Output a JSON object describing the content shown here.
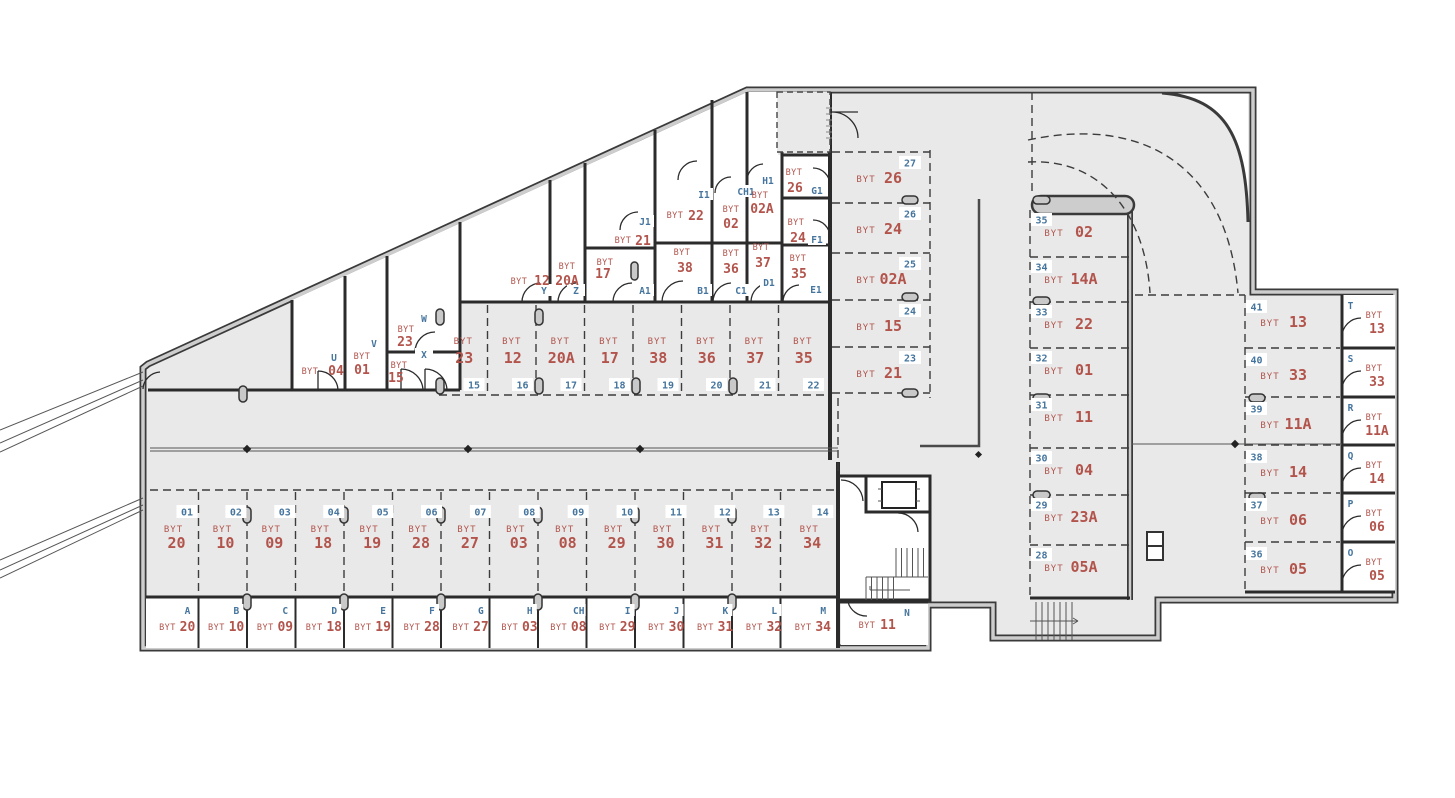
{
  "labels": {
    "unit_prefix": "BYT"
  },
  "colors": {
    "unit_red": "#b2544c",
    "code_blue": "#45759e",
    "floor_grey": "#e9e9e9",
    "wall_dark": "#3a3a3a"
  },
  "parking": {
    "bottom_row": [
      {
        "stall": "01",
        "unit": "20"
      },
      {
        "stall": "02",
        "unit": "10"
      },
      {
        "stall": "03",
        "unit": "09"
      },
      {
        "stall": "04",
        "unit": "18"
      },
      {
        "stall": "05",
        "unit": "19"
      },
      {
        "stall": "06",
        "unit": "28"
      },
      {
        "stall": "07",
        "unit": "27"
      },
      {
        "stall": "08",
        "unit": "03"
      },
      {
        "stall": "09",
        "unit": "08"
      },
      {
        "stall": "10",
        "unit": "29"
      },
      {
        "stall": "11",
        "unit": "30"
      },
      {
        "stall": "12",
        "unit": "31"
      },
      {
        "stall": "13",
        "unit": "32"
      },
      {
        "stall": "14",
        "unit": "34"
      }
    ],
    "middle_row": [
      {
        "stall": "15",
        "unit": "23"
      },
      {
        "stall": "16",
        "unit": "12"
      },
      {
        "stall": "17",
        "unit": "20A"
      },
      {
        "stall": "18",
        "unit": "17"
      },
      {
        "stall": "19",
        "unit": "38"
      },
      {
        "stall": "20",
        "unit": "36"
      },
      {
        "stall": "21",
        "unit": "37"
      },
      {
        "stall": "22",
        "unit": "35"
      }
    ],
    "upper_column": [
      {
        "stall": "27",
        "unit": "26"
      },
      {
        "stall": "26",
        "unit": "24"
      },
      {
        "stall": "25",
        "unit": "02A"
      },
      {
        "stall": "24",
        "unit": "15"
      },
      {
        "stall": "23",
        "unit": "21"
      }
    ],
    "right_column": [
      {
        "stall": "35",
        "unit": "02"
      },
      {
        "stall": "34",
        "unit": "14A"
      },
      {
        "stall": "33",
        "unit": "22"
      },
      {
        "stall": "32",
        "unit": "01"
      },
      {
        "stall": "31",
        "unit": "11"
      },
      {
        "stall": "30",
        "unit": "04"
      },
      {
        "stall": "29",
        "unit": "23A"
      },
      {
        "stall": "28",
        "unit": "05A"
      }
    ],
    "far_right_column": [
      {
        "stall": "41",
        "unit": "13"
      },
      {
        "stall": "40",
        "unit": "33"
      },
      {
        "stall": "39",
        "unit": "11A"
      },
      {
        "stall": "38",
        "unit": "14"
      },
      {
        "stall": "37",
        "unit": "06"
      },
      {
        "stall": "36",
        "unit": "05"
      }
    ]
  },
  "cellars": {
    "bottom_row": [
      {
        "code": "A",
        "unit": "20"
      },
      {
        "code": "B",
        "unit": "10"
      },
      {
        "code": "C",
        "unit": "09"
      },
      {
        "code": "D",
        "unit": "18"
      },
      {
        "code": "E",
        "unit": "19"
      },
      {
        "code": "F",
        "unit": "28"
      },
      {
        "code": "G",
        "unit": "27"
      },
      {
        "code": "H",
        "unit": "03"
      },
      {
        "code": "CH",
        "unit": "08"
      },
      {
        "code": "I",
        "unit": "29"
      },
      {
        "code": "J",
        "unit": "30"
      },
      {
        "code": "K",
        "unit": "31"
      },
      {
        "code": "L",
        "unit": "32"
      },
      {
        "code": "M",
        "unit": "34"
      },
      {
        "code": "N",
        "unit": "11"
      }
    ],
    "right_column": [
      {
        "code": "T",
        "unit": "13"
      },
      {
        "code": "S",
        "unit": "33"
      },
      {
        "code": "R",
        "unit": "11A"
      },
      {
        "code": "Q",
        "unit": "14"
      },
      {
        "code": "P",
        "unit": "06"
      },
      {
        "code": "O",
        "unit": "05"
      }
    ],
    "top_band": [
      {
        "code": "U",
        "unit": "04"
      },
      {
        "code": "V",
        "unit": "01"
      },
      {
        "code": "W",
        "unit": "23"
      },
      {
        "code": "X",
        "unit": "15"
      },
      {
        "code": "Y",
        "unit": "12"
      },
      {
        "code": "Z",
        "unit": "20A"
      },
      {
        "code": "A1",
        "unit": "17"
      },
      {
        "code": "J1",
        "unit": "21"
      },
      {
        "code": "B1",
        "unit": "38"
      },
      {
        "code": "C1",
        "unit": "36"
      },
      {
        "code": "D1",
        "unit": "37"
      },
      {
        "code": "I1",
        "unit": "22"
      },
      {
        "code": "CH1",
        "unit": "02"
      },
      {
        "code": "H1",
        "unit": "02A"
      },
      {
        "code": "E1",
        "unit": "35"
      },
      {
        "code": "F1",
        "unit": "24"
      },
      {
        "code": "G1",
        "unit": "26"
      }
    ]
  }
}
